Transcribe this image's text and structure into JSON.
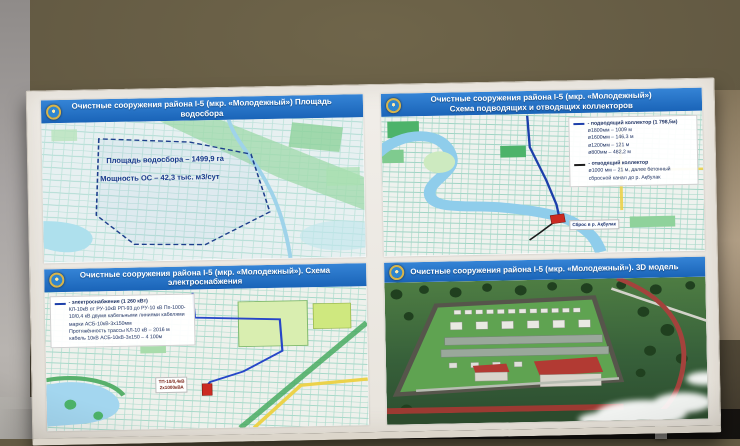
{
  "board": {
    "panels": {
      "watershed": {
        "title": "Очистные сооружения района I-5 (мкр. «Молодежный»)  Площадь водосбора",
        "area_label": "Площадь водосбора – 1499,9 га",
        "capacity_label": "Мощность ОС – 42,3 тыс. м3/сут"
      },
      "collectors": {
        "title_line1": "Очистные сооружения района I-5 (мкр. «Молодежный»)",
        "title_line2": "Схема подводящих и отводящих коллекторов",
        "legend": {
          "supply_label": "- подводящий коллектор (1 798,5м)",
          "supply_d1": "ø1800мм – 1009 м",
          "supply_d2": "ø1600мм – 146,3 м",
          "supply_d3": "ø1200мм – 121 м",
          "supply_d4": "ø800мм – 482,2 м",
          "discharge_label": "- отводящий коллектор",
          "discharge_d1": "ø1000 мм – 21 м, далее бетонный",
          "discharge_d2": "сбросной канал до р. Ақбулак"
        },
        "discharge_point_label": "Сброс в р. Ақбулак"
      },
      "power": {
        "title": "Очистные сооружения района I-5 (мкр. «Молодежный»). Схема электроснабжения",
        "legend": {
          "line_label": "- электроснабжение (1 260 кВт)",
          "detail": "КЛ-10кВ от РУ-10кВ РП-93 до РУ-10 кВ Пп-1000-10/0,4 кВ двумя кабельными линиями кабелями марки АСБ-10кВ-3х150мм",
          "length_line": "Протяжённость трассы КЛ-10 кВ – 2016 м",
          "cable_line": "кабель 10кВ АСБ-10кВ-3х150 – 4 100м"
        },
        "substation_label_line1": "ТП-10/0,4кВ",
        "substation_label_line2": "2х1000кВА"
      },
      "model3d": {
        "title": "Очистные сооружения района I-5 (мкр. «Молодежный»). 3D модель"
      }
    },
    "colors": {
      "header_blue": "#1e6ec4",
      "site_red": "#c42a20",
      "collector_blue": "#1c3faa",
      "cable_blue": "#2746c8",
      "river_blue": "#9ed3ef",
      "park_green": "#4db36a"
    }
  }
}
